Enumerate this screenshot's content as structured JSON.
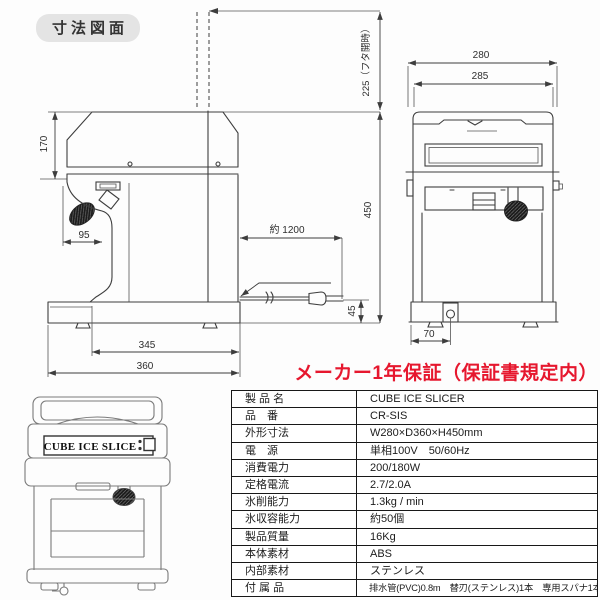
{
  "title": "寸法図面",
  "warranty": {
    "text": "メーカー1年保証（保証書規定内）",
    "color": "#e6172e"
  },
  "colors": {
    "drawing_line": "#3d3d3d",
    "illustration_line": "#7a7a7a",
    "table_border": "#181818"
  },
  "diagram": {
    "side_view": {
      "dim_lid_open": "225（フタ開時）",
      "dim_hood_height": "170",
      "dim_handle": "95",
      "dim_height": "450",
      "dim_cord": "約 1200",
      "dim_cord_height": "45",
      "dim_inner_depth": "345",
      "dim_depth": "360"
    },
    "front_view": {
      "dim_width": "280",
      "dim_lid_width": "285",
      "dim_drain": "70"
    }
  },
  "illustration": {
    "label": "CUBE ICE SLICE"
  },
  "spec_table": {
    "rows": [
      {
        "label": "製 品 名",
        "value": "CUBE ICE SLICER"
      },
      {
        "label": "品　番",
        "value": "CR-SIS"
      },
      {
        "label": "外形寸法",
        "value": "W280×D360×H450mm"
      },
      {
        "label": "電　源",
        "value": "単相100V　50/60Hz"
      },
      {
        "label": "消費電力",
        "value": "200/180W"
      },
      {
        "label": "定格電流",
        "value": "2.7/2.0A"
      },
      {
        "label": "氷削能力",
        "value": "1.3kg / min"
      },
      {
        "label": "氷収容能力",
        "value": "約50個"
      },
      {
        "label": "製品質量",
        "value": "16Kg"
      },
      {
        "label": "本体素材",
        "value": "ABS"
      },
      {
        "label": "内部素材",
        "value": "ステンレス"
      },
      {
        "label": "付 属 品",
        "value": "排水管(PVC)0.8m　替刃(ステンレス)1本　専用スパナ1本"
      }
    ]
  }
}
